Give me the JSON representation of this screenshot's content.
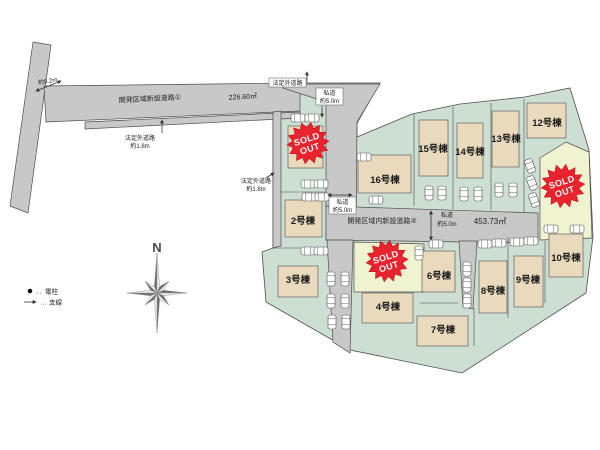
{
  "roads": {
    "road1_name": "開発区域新設道路①",
    "road1_area": "226.60㎡",
    "road2_name": "開発区域内新設道路②",
    "road2_area": "453.73㎡",
    "approach_width": "約5.2m",
    "unofficial_road": "法定外道路",
    "unofficial_width": "約1.8m",
    "private_road": "私道",
    "private_width": "約5.0m"
  },
  "lots": {
    "lot2": "2号棟",
    "lot3": "3号棟",
    "lot4": "4号棟",
    "lot6": "6号棟",
    "lot7": "7号棟",
    "lot8": "8号棟",
    "lot9": "9号棟",
    "lot10": "10号棟",
    "lot12": "12号棟",
    "lot13": "13号棟",
    "lot14": "14号棟",
    "lot15": "15号棟",
    "lot16": "16号棟"
  },
  "sold_stamp": {
    "line1": "SOLD",
    "line2": "OUT"
  },
  "compass": {
    "label": "N"
  },
  "legend": {
    "dots": "…",
    "pole": "電柱",
    "guy_wire": "支線"
  },
  "colors": {
    "road_gray": "#c8c8c9",
    "lot_green": "#cddfd3",
    "building_beige": "#e9d9bd",
    "sold_lot_yellow": "#f0f3d0",
    "stamp_red": "#e8232d"
  }
}
